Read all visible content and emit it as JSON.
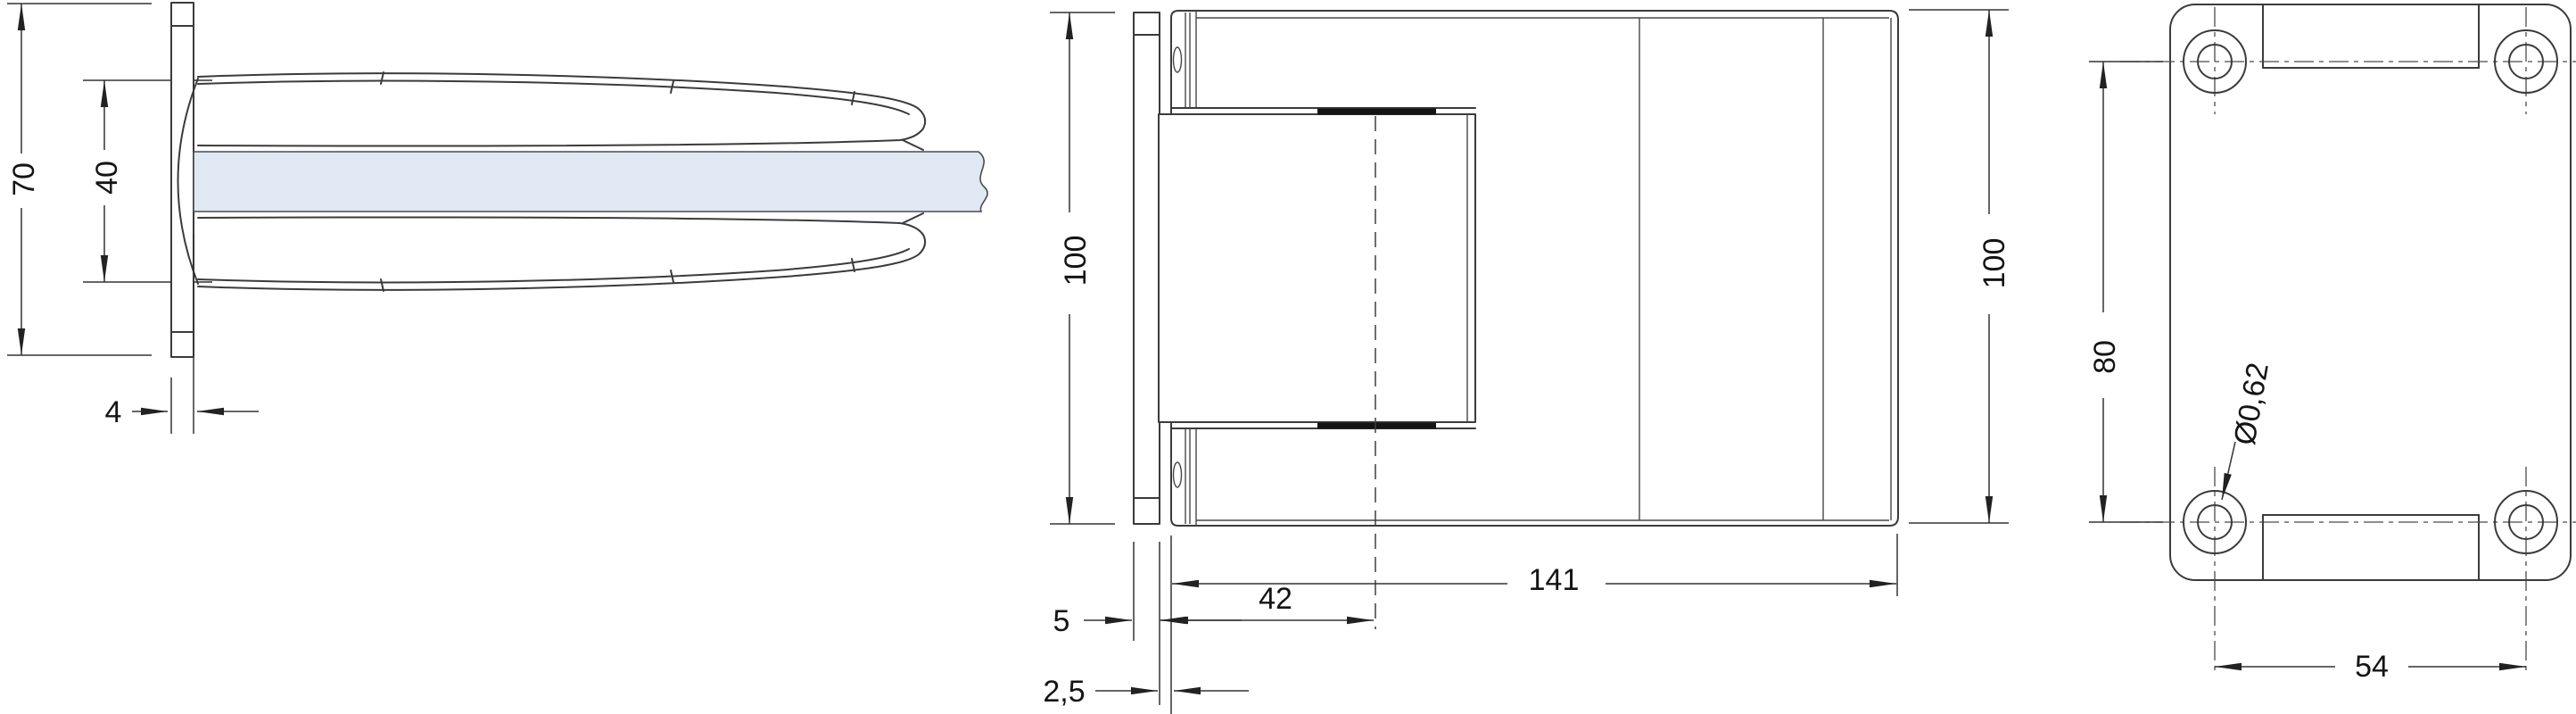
{
  "drawing": {
    "colors": {
      "background": "#ffffff",
      "line": "#3b3b3b",
      "glass_fill": "#dfe8f3",
      "text": "#141414"
    },
    "side_view": {
      "dim_total_height": "70",
      "dim_glass_height": "40",
      "dim_plate_thickness": "4"
    },
    "front_view": {
      "dim_height_left": "100",
      "dim_height_right": "100",
      "dim_total_width": "141",
      "dim_pivot_offset": "42",
      "dim_plate_thickness": "5",
      "dim_gap": "2,5"
    },
    "plan_view": {
      "dim_hole_pitch_vertical": "80",
      "dim_hole_pitch_horizontal": "54",
      "dim_hole_diameter": "Ø0,62"
    }
  }
}
